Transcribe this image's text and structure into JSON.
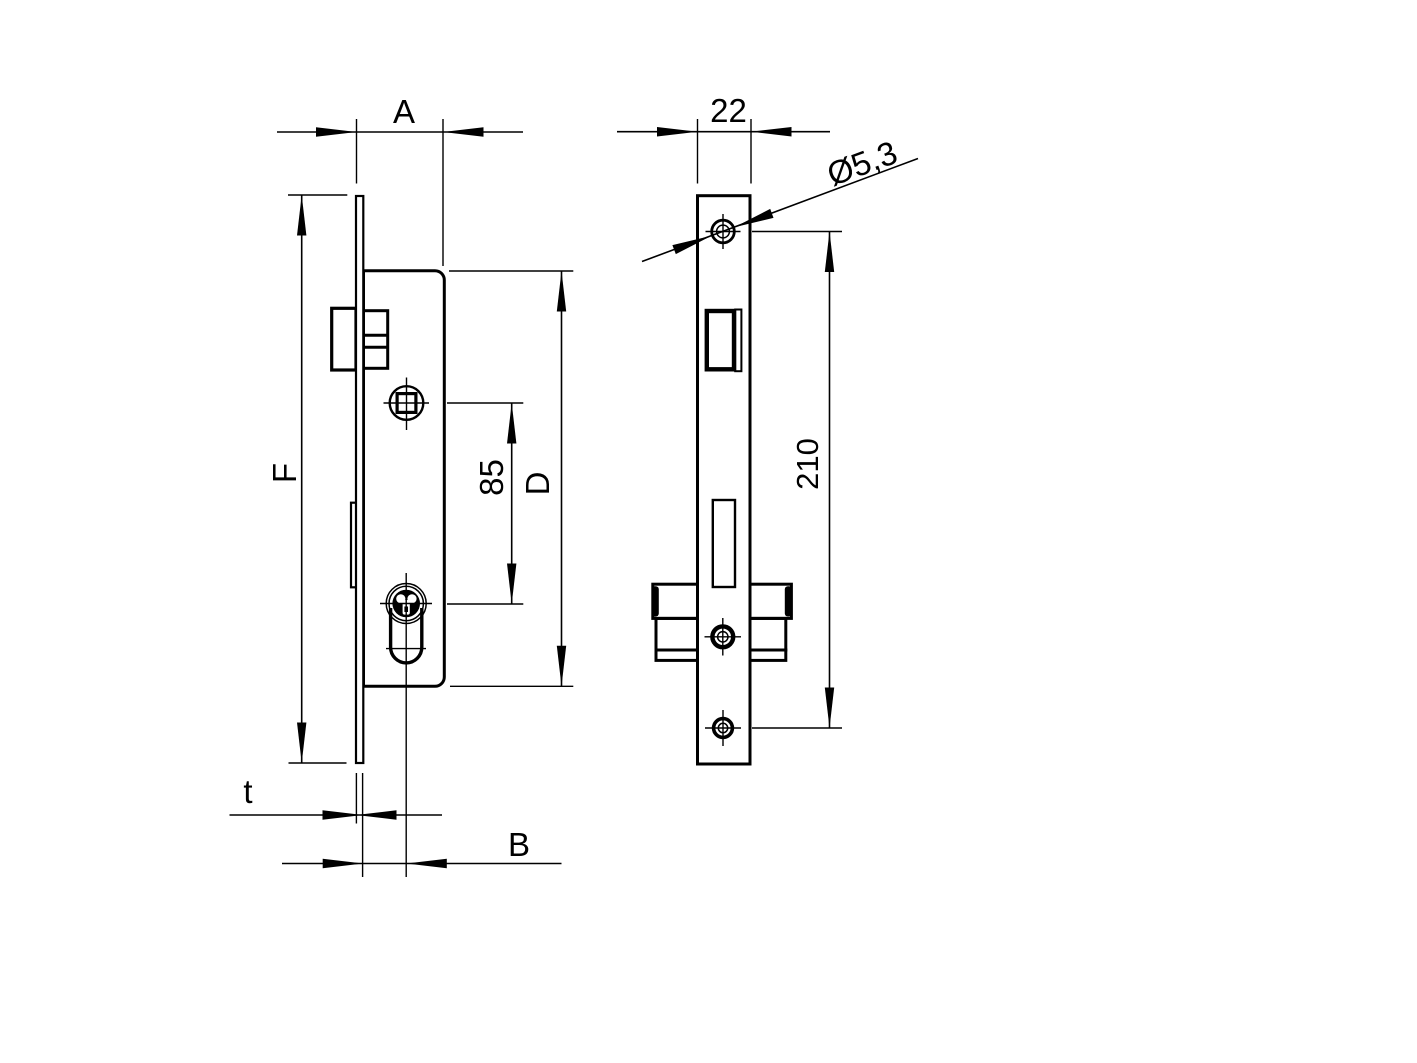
{
  "colors": {
    "line": "#000000",
    "background": "#ffffff"
  },
  "dimensions": {
    "case_width_label": "A",
    "faceplate_width": "22",
    "screw_hole_diameter": "Ø5,3",
    "faceplate_height_label": "F",
    "spindle_to_cylinder": "85",
    "case_height_label": "D",
    "screw_spacing": "210",
    "faceplate_thickness_label": "t",
    "backset_label": "B"
  }
}
